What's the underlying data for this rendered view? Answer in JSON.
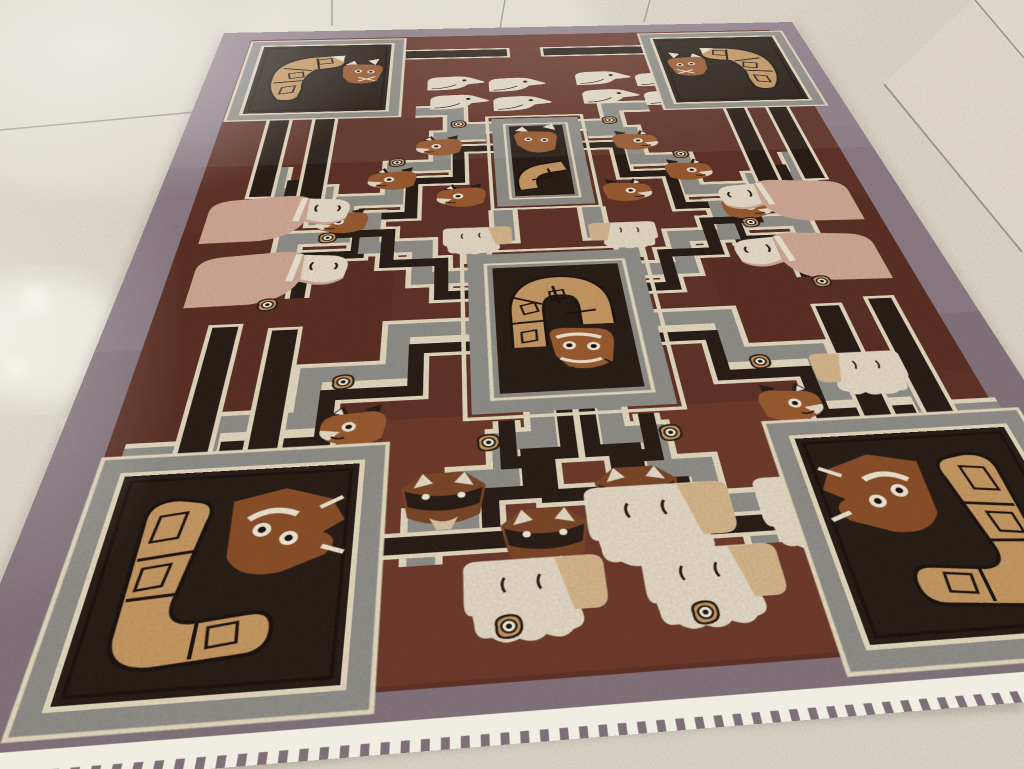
{
  "meta": {
    "type": "photograph",
    "subject": "Vintage hand-knotted pictorial wool rug with stylized llama, fox, bird and cat motifs, laid at an angle on a speckled terrazzo tile floor",
    "view": "standing-height perspective, rug receding toward the top of the frame"
  },
  "palette": {
    "floor_base": "#cdc6b6",
    "floor_worn": "#ddd8cc",
    "floor_bright": "#efede2",
    "grout": "#8f897c",
    "rug_border_mauve": "#8b7c86",
    "rug_border_dark": "#7e6f78",
    "field_maroon": "#5e3026",
    "field_rust": "#70392a",
    "black_brown": "#241a14",
    "band_gray": "#8f8f89",
    "cream": "#e6dcc2",
    "white_fringe": "#f0ede2",
    "tan": "#c89a62",
    "salmon": "#d2aa97",
    "rust": "#9a5a2e",
    "fox_brown": "#7a4526"
  },
  "rug": {
    "border": "plain mauve-gray band, white fringe along the bottom edge",
    "field": "dark maroon brown with lighter rust patches",
    "maze": "stepped gray and black fret bands with cream piping radiating from the medallions",
    "medallions": {
      "center": "square medallion with smiling cat face and segmented tan arch",
      "upper": "smaller square medallion with fox face and tan scroll",
      "corners": "four framed corner boxes, each with a fox or owl face and a segmented tan scroll"
    },
    "motif_counts": {
      "cream_birds": 8,
      "fox_heads": 10,
      "masked_foxes": 3,
      "pink_llamas": 4,
      "big_cream_llamas": 4,
      "small_cream_llamas": 3,
      "rosettes": 14
    }
  },
  "floor": {
    "material": "speckled terrazzo tiles",
    "grout_lines": 6,
    "worn_patch": "polished pale area at upper left and bright scuffs along the left edge"
  }
}
